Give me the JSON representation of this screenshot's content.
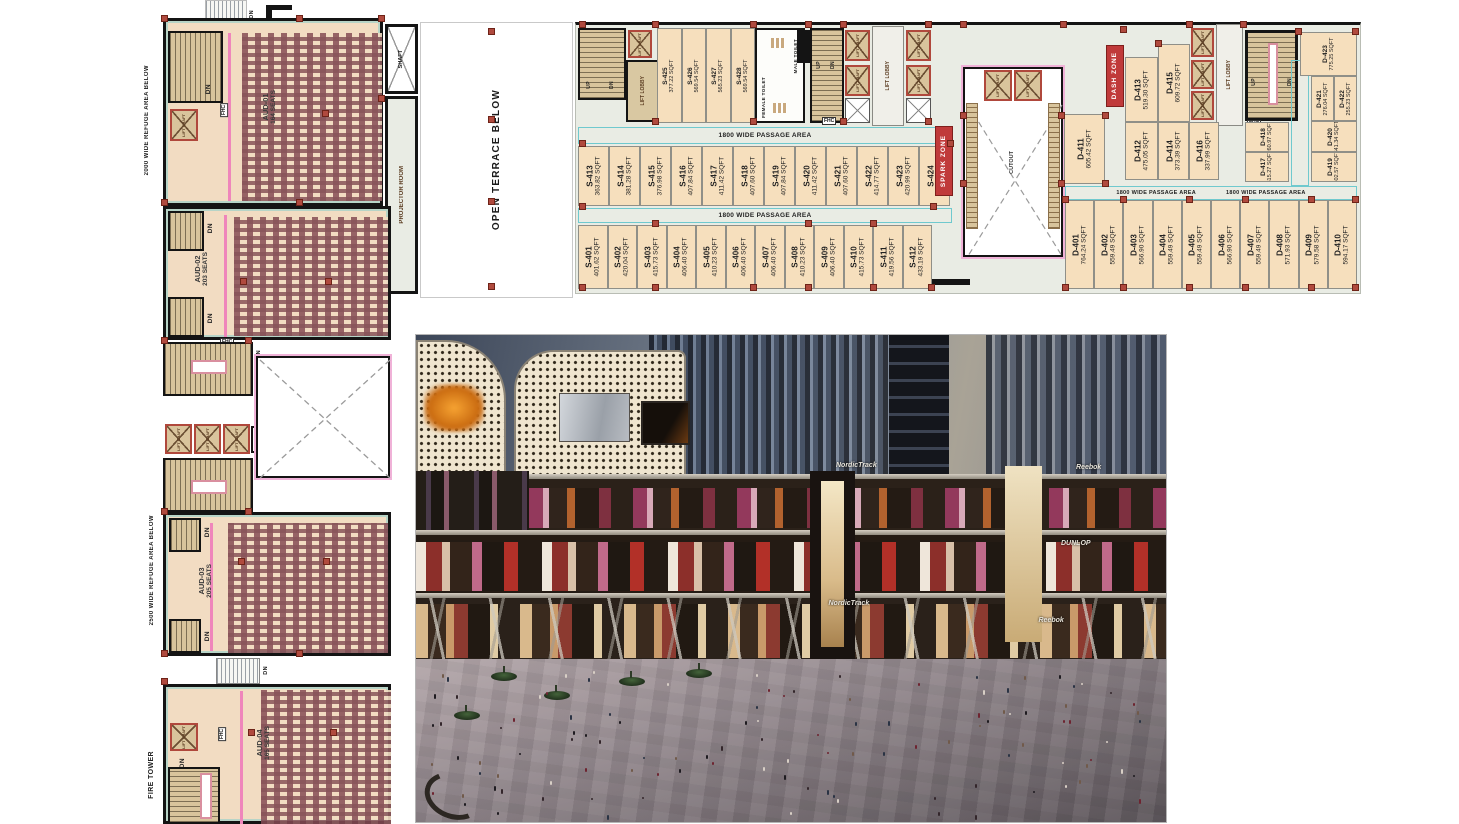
{
  "plan": {
    "labels": {
      "open_terrace": "OPEN TERRACE BELOW",
      "refuge_2000": "2000 WIDE REFUGE AREA BELOW",
      "refuge_2500": "2500 WIDE REFUGE AREA BELOW",
      "fire_tower": "FIRE TOWER",
      "projector_room": "PROJECTOR ROOM",
      "shaft": "SHAFT",
      "lift_lobby": "LIFT LOBBY",
      "lift_shaft": "LIFT SHAFT",
      "male_toilet": "MALE TOILET",
      "female_toilet": "FEMALE TOILET",
      "passage": "1800 WIDE PASSAGE AREA",
      "spark_zone": "SPARK ZONE",
      "dash_zone": "DASH ZONE",
      "cutout": "CUTOUT",
      "up": "UP",
      "dn": "DN",
      "fhc": "FHC"
    },
    "auditoriums": [
      {
        "id": "AUD-01",
        "seats": "164 SEATS"
      },
      {
        "id": "AUD-02",
        "seats": "203 SEATS"
      },
      {
        "id": "AUD-03",
        "seats": "205 SEATS"
      },
      {
        "id": "AUD-04",
        "seats": "165 SEATS"
      }
    ],
    "units": {
      "s_top": [
        {
          "name": "S-425",
          "sqft": "377.22 SQFT"
        },
        {
          "name": "S-426",
          "sqft": "569.54 SQFT"
        },
        {
          "name": "S-427",
          "sqft": "565.23 SQFT"
        },
        {
          "name": "S-428",
          "sqft": "569.54 SQFT"
        }
      ],
      "s_mid": [
        {
          "name": "S-413",
          "sqft": "363.82 SQFT"
        },
        {
          "name": "S-414",
          "sqft": "381.28 SQFT"
        },
        {
          "name": "S-415",
          "sqft": "376.98 SQFT"
        },
        {
          "name": "S-416",
          "sqft": "407.84 SQFT"
        },
        {
          "name": "S-417",
          "sqft": "411.42 SQFT"
        },
        {
          "name": "S-418",
          "sqft": "407.60 SQFT"
        },
        {
          "name": "S-419",
          "sqft": "407.84 SQFT"
        },
        {
          "name": "S-420",
          "sqft": "411.42 SQFT"
        },
        {
          "name": "S-421",
          "sqft": "407.60 SQFT"
        },
        {
          "name": "S-422",
          "sqft": "414.77 SQFT"
        },
        {
          "name": "S-423",
          "sqft": "420.99 SQFT"
        },
        {
          "name": "S-424",
          "sqft": "434.63 SQFT"
        }
      ],
      "s_bottom": [
        {
          "name": "S-401",
          "sqft": "401.62 SQFT"
        },
        {
          "name": "S-402",
          "sqft": "420.04 SQFT"
        },
        {
          "name": "S-403",
          "sqft": "415.73 SQFT"
        },
        {
          "name": "S-404",
          "sqft": "406.40 SQFT"
        },
        {
          "name": "S-405",
          "sqft": "410.23 SQFT"
        },
        {
          "name": "S-406",
          "sqft": "406.40 SQFT"
        },
        {
          "name": "S-407",
          "sqft": "406.40 SQFT"
        },
        {
          "name": "S-408",
          "sqft": "410.23 SQFT"
        },
        {
          "name": "S-409",
          "sqft": "406.40 SQFT"
        },
        {
          "name": "S-410",
          "sqft": "415.73 SQFT"
        },
        {
          "name": "S-411",
          "sqft": "419.56 SQFT"
        },
        {
          "name": "S-412",
          "sqft": "433.19 SQFT"
        }
      ],
      "d_bottom": [
        {
          "name": "D-401",
          "sqft": "764.24 SQFT"
        },
        {
          "name": "D-402",
          "sqft": "559.49 SQFT"
        },
        {
          "name": "D-403",
          "sqft": "566.90 SQFT"
        },
        {
          "name": "D-404",
          "sqft": "559.49 SQFT"
        },
        {
          "name": "D-405",
          "sqft": "559.49 SQFT"
        },
        {
          "name": "D-406",
          "sqft": "566.90 SQFT"
        },
        {
          "name": "D-407",
          "sqft": "559.49 SQFT"
        },
        {
          "name": "D-408",
          "sqft": "571.93 SQFT"
        },
        {
          "name": "D-409",
          "sqft": "579.58 SQFT"
        },
        {
          "name": "D-410",
          "sqft": "594.17 SQFT"
        }
      ],
      "d": {
        "d411": {
          "name": "D-411",
          "sqft": "605.42 SQFT"
        },
        "d412": {
          "name": "D-412",
          "sqft": "475.05 SQFT"
        },
        "d413": {
          "name": "D-413",
          "sqft": "519.30 SQFT"
        },
        "d414": {
          "name": "D-414",
          "sqft": "373.39 SQFT"
        },
        "d415": {
          "name": "D-415",
          "sqft": "609.72 SQFT"
        },
        "d416": {
          "name": "D-416",
          "sqft": "337.99 SQFT"
        },
        "d417": {
          "name": "D-417",
          "sqft": "315.27 SQFT"
        },
        "d418": {
          "name": "D-418",
          "sqft": "260.97 SQFT"
        },
        "d419": {
          "name": "D-419",
          "sqft": "402.57 SQFT"
        },
        "d420": {
          "name": "D-420",
          "sqft": "341.34 SQFT"
        },
        "d421": {
          "name": "D-421",
          "sqft": "276.04 SQFT"
        },
        "d422": {
          "name": "D-422",
          "sqft": "255.23 SQFT"
        },
        "d423": {
          "name": "D-423",
          "sqft": "775.25 SQFT"
        }
      }
    }
  },
  "render": {
    "signs": {
      "nordictrack": "NordicTrack",
      "reebok": "Reebok",
      "dunlop": "DUNLOP"
    }
  },
  "colors": {
    "unit_fill": "#f6dfbd",
    "passage_bg": "#e9ece4",
    "wall": "#141414",
    "cyan_line": "#6fc9ce",
    "column_marker": "#b04a3e",
    "zone_red": "#c03a3a",
    "stair_tan": "#d8c49c",
    "screen_pink": "#ef86bb"
  }
}
